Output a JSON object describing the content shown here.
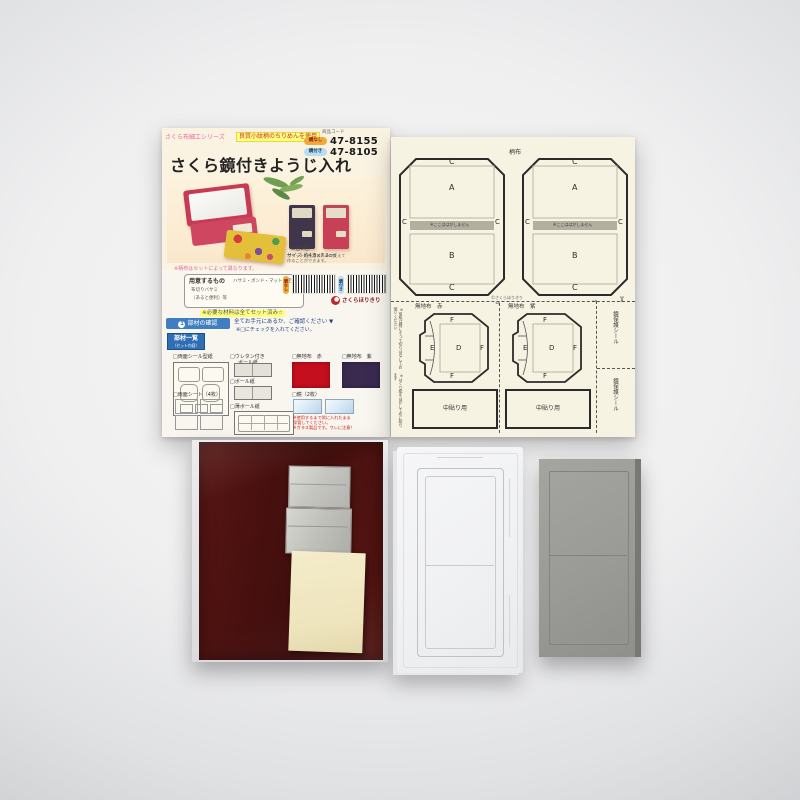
{
  "instruction_sheet": {
    "series_label": "さくら布細工シリーズ",
    "quality_note": "良質小紋柄のちりめんを使用",
    "code_label": "商品コード",
    "variants": [
      {
        "badge": "鏡なし",
        "code": "47-8155"
      },
      {
        "badge": "鏡付き",
        "code": "47-8105"
      }
    ],
    "title": "さくら鏡付きようじ入れ",
    "pocket_note_l1": "ポケットの位置は好みで変えて",
    "pocket_note_l2": "作ることができます。",
    "set_count": "（2個1組）",
    "size": "サイズ 約4.5×7.2cm",
    "fabric_caption": "※柄布はセットによって異なります。",
    "prepare_label": "用意するもの",
    "prepare_items": "ハサミ・ボンド・マット・定規",
    "prepare_line2": "布切りバサミ",
    "prepare_line3": "（あると便利）等",
    "included_note": "※必要な材料は全てセット済み☆",
    "brand": "さくらほりきり",
    "step1": {
      "num": "1",
      "label": "部材の確認",
      "text": "全てお手元にあるか、ご確認ください ▼",
      "sub": "※□にチェックを入れてください。"
    },
    "parts_badge": "部材一覧",
    "parts_badge_sub": "（セット内容）",
    "parts": {
      "p1": "□両面シール型紙",
      "p2a": "□ウレタン付き",
      "p2b": "ボール紙",
      "p3": "□ボール紙",
      "p4": "□無地布　赤",
      "p5": "□無地布　紫",
      "p6": "□両面シート（4枚）",
      "p7": "□薄ボール紙",
      "p8": "□鏡（2枚）"
    },
    "mirror_note_l1": "※使用するまで袋に入れたまま",
    "mirror_note_l2": "保管してください。",
    "mirror_note_l3": "※ガラス製品です。ワレに注意！"
  },
  "pattern_sheet": {
    "fabric_label_top": "柄布",
    "letters": {
      "A": "A",
      "B": "B",
      "C": "C",
      "D": "D",
      "E": "E",
      "F": "F"
    },
    "strip_note": "※ここははがしません",
    "copyright": "©さくらほりきり",
    "plain_red": "無地布　赤",
    "plain_purple": "無地布　紫",
    "center_label": "中貼り用",
    "protect_label": "鏡保護シール",
    "left_note1": "※型紙は線にそって切りはなしてお使いください",
    "left_note2": "※はくり紙をはがして布に貼ります",
    "scissors_glyph": "✂"
  },
  "colors": {
    "accent_blue": "#3f7fc1",
    "swatch_red": "#c30f1e",
    "swatch_purple": "#3a2a50",
    "highlight_yellow": "#ffff7e",
    "brand_red": "#c0272d",
    "maroon_board": "#4a1110",
    "gray_board": "#9d9d99"
  }
}
